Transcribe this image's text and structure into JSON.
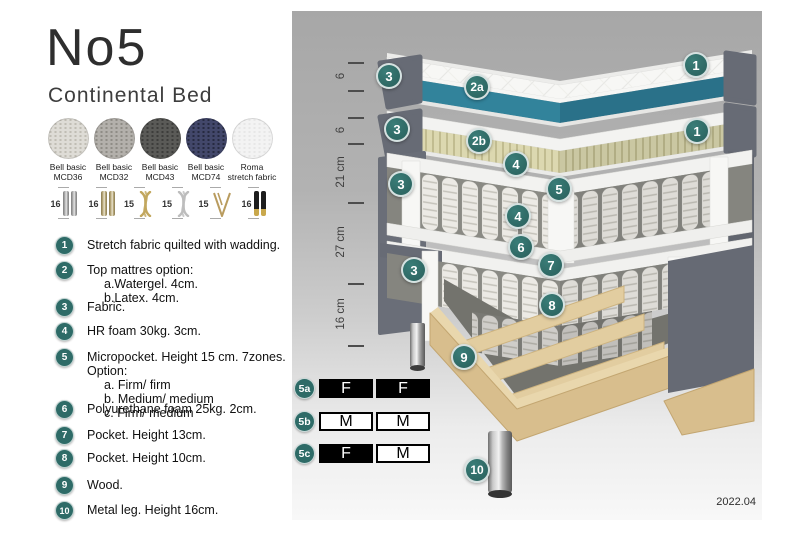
{
  "header": {
    "title": "No5",
    "subtitle": "Continental Bed"
  },
  "fabrics": [
    {
      "line1": "Bell basic",
      "line2": "MCD36",
      "base": "#dedcd6",
      "dot": "#c0bdb4"
    },
    {
      "line1": "Bell basic",
      "line2": "MCD32",
      "base": "#b3b0ab",
      "dot": "#8f8c86"
    },
    {
      "line1": "Bell basic",
      "line2": "MCD43",
      "base": "#5a5a57",
      "dot": "#3d3d3b"
    },
    {
      "line1": "Bell basic",
      "line2": "MCD74",
      "base": "#42476a",
      "dot": "#262a40"
    },
    {
      "line1": "Roma",
      "line2": "stretch fabric",
      "base": "#f3f3f3",
      "dot": "#e7e7e7"
    }
  ],
  "leg_options": [
    {
      "height": "16",
      "style": "pair",
      "c1": "#bcbcbc",
      "c2": "#7d7d7d"
    },
    {
      "height": "16",
      "style": "pair",
      "c1": "#c8b98a",
      "c2": "#8a7a50"
    },
    {
      "height": "15",
      "style": "twist",
      "c1": "#c2a75e"
    },
    {
      "height": "15",
      "style": "twist",
      "c1": "#bdbdbd"
    },
    {
      "height": "15",
      "style": "hairpin",
      "c1": "#b99c5f"
    },
    {
      "height": "16",
      "style": "pair-tip",
      "c1": "#1d1d1d",
      "c2": "#c9a84c"
    }
  ],
  "legend": [
    {
      "num": "1",
      "text": "Stretch fabric quilted with wadding.",
      "subs": []
    },
    {
      "num": "2",
      "text": "Top mattres option:",
      "subs": [
        "a.Watergel. 4cm.",
        "b.Latex. 4cm."
      ]
    },
    {
      "num": "3",
      "text": "Fabric.",
      "subs": []
    },
    {
      "num": "4",
      "text": "HR foam 30kg. 3cm.",
      "subs": []
    },
    {
      "num": "5",
      "text": "Micropocket. Height 15 cm. 7zones. Option:",
      "subs": [
        "a. Firm/ firm",
        "b. Medium/ medium",
        "c. Firm/ medium"
      ]
    },
    {
      "num": "6",
      "text": "Polyurethane foam 25kg. 2cm.",
      "subs": []
    },
    {
      "num": "7",
      "text": "Pocket. Height 13cm.",
      "subs": []
    },
    {
      "num": "8",
      "text": "Pocket. Height 10cm.",
      "subs": []
    },
    {
      "num": "9",
      "text": "Wood.",
      "subs": []
    },
    {
      "num": "10",
      "text": "Metal leg. Height 16cm.",
      "subs": []
    }
  ],
  "diagram": {
    "badges": [
      {
        "label": "1",
        "x": 404,
        "y": 54
      },
      {
        "label": "2a",
        "x": 185,
        "y": 76
      },
      {
        "label": "3",
        "x": 97,
        "y": 65
      },
      {
        "label": "1",
        "x": 405,
        "y": 120
      },
      {
        "label": "2b",
        "x": 187,
        "y": 130
      },
      {
        "label": "3",
        "x": 105,
        "y": 118
      },
      {
        "label": "4",
        "x": 224,
        "y": 153
      },
      {
        "label": "5",
        "x": 267,
        "y": 178
      },
      {
        "label": "3",
        "x": 109,
        "y": 173
      },
      {
        "label": "4",
        "x": 226,
        "y": 205
      },
      {
        "label": "6",
        "x": 229,
        "y": 236
      },
      {
        "label": "7",
        "x": 259,
        "y": 254
      },
      {
        "label": "3",
        "x": 122,
        "y": 259
      },
      {
        "label": "8",
        "x": 260,
        "y": 294
      },
      {
        "label": "9",
        "x": 172,
        "y": 346
      },
      {
        "label": "10",
        "x": 185,
        "y": 459
      }
    ],
    "scale": {
      "ticks": [
        51,
        79,
        106,
        132,
        191,
        272,
        334
      ],
      "labels": [
        {
          "text": "6",
          "y": 65
        },
        {
          "text": "6",
          "y": 119
        },
        {
          "text": "21 cm",
          "y": 161
        },
        {
          "text": "27 cm",
          "y": 231
        },
        {
          "text": "16 cm",
          "y": 303
        }
      ]
    },
    "firmness": [
      {
        "id": "5a",
        "top": 367,
        "cells": [
          {
            "letter": "F",
            "dark": true
          },
          {
            "letter": "F",
            "dark": true
          }
        ]
      },
      {
        "id": "5b",
        "top": 400,
        "cells": [
          {
            "letter": "M",
            "dark": false
          },
          {
            "letter": "M",
            "dark": false
          }
        ]
      },
      {
        "id": "5c",
        "top": 432,
        "cells": [
          {
            "letter": "F",
            "dark": true
          },
          {
            "letter": "M",
            "dark": false
          }
        ]
      }
    ],
    "version": "2022.04"
  },
  "colors": {
    "badge_teal": "#2e6b67",
    "watergel_teal": "#2f7e95",
    "fabric_gray": "#676b75"
  }
}
